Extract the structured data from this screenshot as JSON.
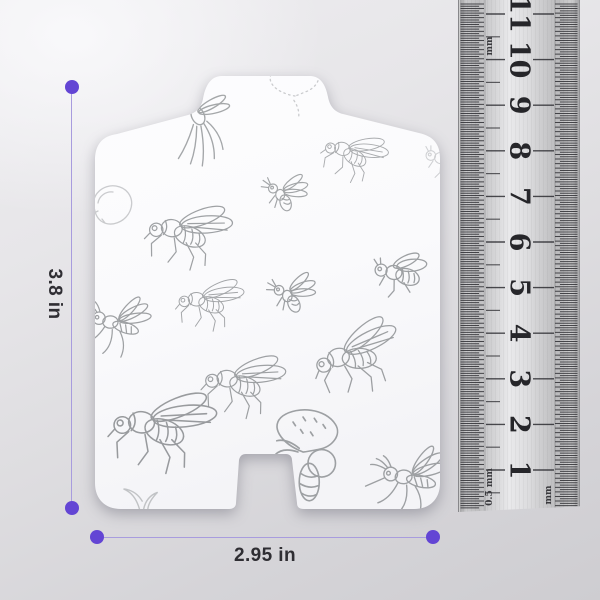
{
  "image_type": "product dimension illustration",
  "colors": {
    "accent_purple": "#6345d4",
    "dim_line_purple": "#a89cde",
    "label_text": "#2f2e33",
    "sketch_gray": "#8e9194",
    "ruler_number": "#26262a",
    "card_fill": "#fbfbfd"
  },
  "dimensions": {
    "height_label": "3.8 in",
    "width_label": "2.95 in"
  },
  "ruler": {
    "numbers": [
      "1",
      "2",
      "3",
      "4",
      "5",
      "6",
      "7",
      "8",
      "9",
      "10",
      "11"
    ],
    "label_top_left": "mm",
    "label_bottom_left": "0.5 mm",
    "label_bottom_right": "mm",
    "first_number_y": 476,
    "number_spacing": 45.6,
    "tick_spacing": 2.28,
    "tick_top": 10,
    "tick_bottom": 516
  },
  "card": {
    "description": "white glue-board card with hang tab and bottom notch, printed with sketched insects",
    "insects": [
      {
        "type": "cranefly",
        "x": 196,
        "y": 118,
        "scale": 1.05,
        "rot": -5,
        "flip": 1,
        "opacity": 0.8
      },
      {
        "type": "dotted-moth",
        "x": 295,
        "y": 96,
        "scale": 1.0,
        "rot": -12,
        "flip": 1,
        "opacity": 0.45
      },
      {
        "type": "fly",
        "x": 352,
        "y": 152,
        "scale": 0.72,
        "rot": 18,
        "flip": 1,
        "opacity": 0.75
      },
      {
        "type": "wasp",
        "x": 282,
        "y": 193,
        "scale": 0.9,
        "rot": 0,
        "flip": 1,
        "opacity": 0.8
      },
      {
        "type": "fly",
        "x": 185,
        "y": 230,
        "scale": 0.95,
        "rot": 8,
        "flip": 1,
        "opacity": 0.85
      },
      {
        "type": "circle-sketch",
        "x": 112,
        "y": 205,
        "scale": 1.0,
        "rot": 0,
        "flip": 1,
        "opacity": 0.45
      },
      {
        "type": "fly",
        "x": 207,
        "y": 300,
        "scale": 0.75,
        "rot": 4,
        "flip": 1,
        "opacity": 0.8
      },
      {
        "type": "wasp",
        "x": 289,
        "y": 294,
        "scale": 0.95,
        "rot": -6,
        "flip": 1,
        "opacity": 0.85
      },
      {
        "type": "bee",
        "x": 399,
        "y": 272,
        "scale": 1.0,
        "rot": 6,
        "flip": 1,
        "opacity": 0.85
      },
      {
        "type": "mosquito",
        "x": 118,
        "y": 322,
        "scale": 0.95,
        "rot": 0,
        "flip": 1,
        "opacity": 0.85
      },
      {
        "type": "fly",
        "x": 240,
        "y": 380,
        "scale": 0.92,
        "rot": 6,
        "flip": 1,
        "opacity": 0.85
      },
      {
        "type": "fly",
        "x": 352,
        "y": 354,
        "scale": 1.0,
        "rot": -14,
        "flip": 1,
        "opacity": 0.85
      },
      {
        "type": "fly",
        "x": 158,
        "y": 424,
        "scale": 1.18,
        "rot": 6,
        "flip": 1,
        "opacity": 0.9
      },
      {
        "type": "moth",
        "x": 303,
        "y": 452,
        "scale": 1.25,
        "rot": 0,
        "flip": 1,
        "opacity": 0.85
      },
      {
        "type": "mosquito",
        "x": 412,
        "y": 476,
        "scale": 1.05,
        "rot": -6,
        "flip": 1,
        "opacity": 0.85
      },
      {
        "type": "bee",
        "x": 445,
        "y": 158,
        "scale": 0.8,
        "rot": 10,
        "flip": 1,
        "opacity": 0.4
      },
      {
        "type": "leaf",
        "x": 140,
        "y": 500,
        "scale": 1.1,
        "rot": 0,
        "flip": 1,
        "opacity": 0.5
      }
    ]
  }
}
